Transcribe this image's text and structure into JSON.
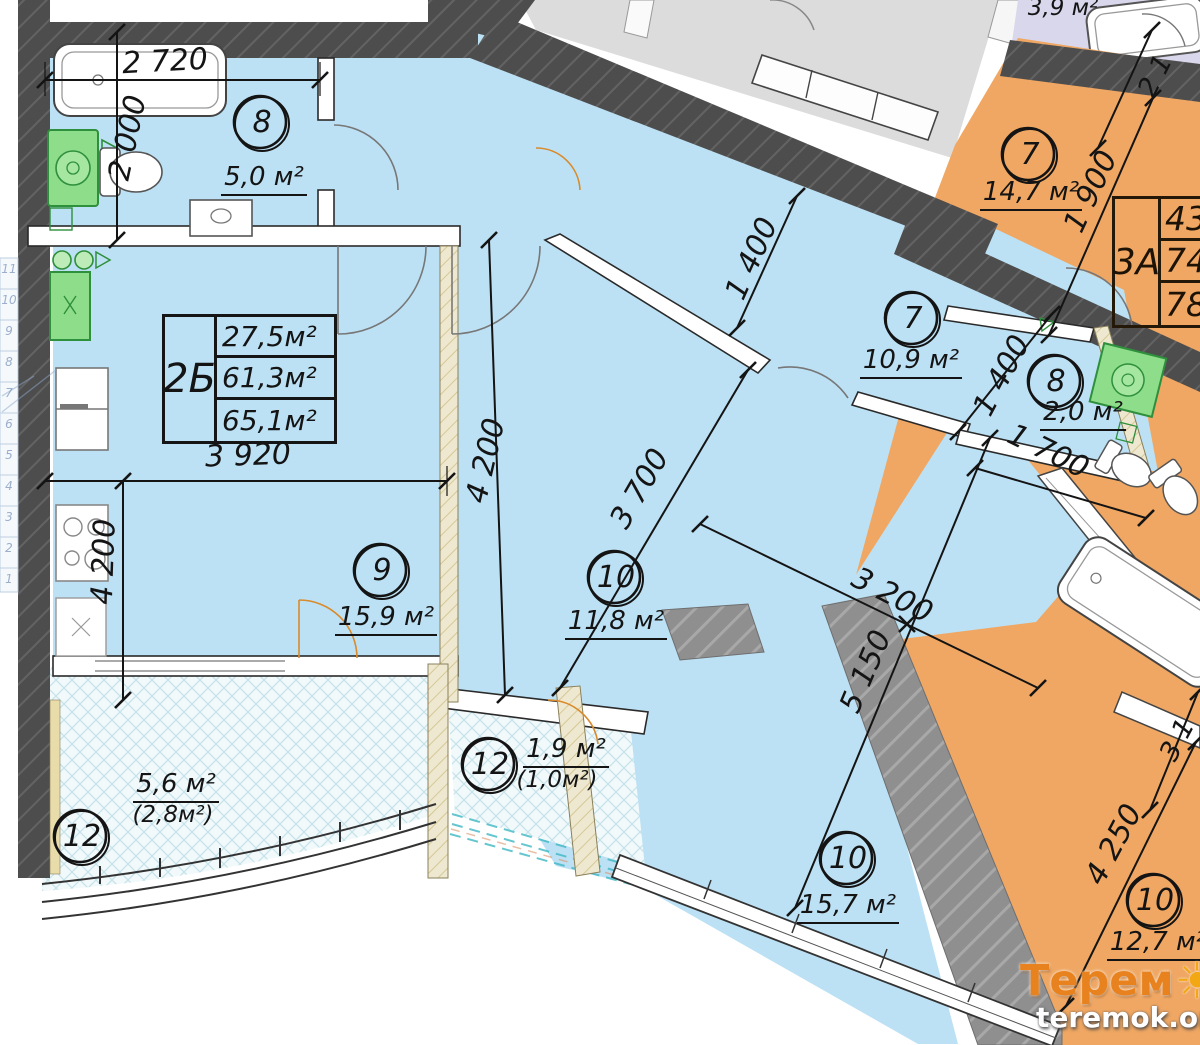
{
  "plan": {
    "table2b": {
      "label": "2Б",
      "rows": [
        "27,5м²",
        "61,3м²",
        "65,1м²"
      ]
    },
    "table3a": {
      "label": "3А",
      "rows": [
        "43",
        "74",
        "78"
      ]
    },
    "rooms": {
      "bath_main": {
        "num": "8",
        "area": "5,0 м²"
      },
      "kitchen_living": {
        "num": "9",
        "area": "15,9 м²"
      },
      "room_mid": {
        "num": "10",
        "area": "11,8 м²"
      },
      "hall": {
        "num": "7",
        "area": "10,9 м²"
      },
      "bath_small": {
        "num": "8",
        "area": "2,0 м²"
      },
      "balcony_large": {
        "num": "12",
        "area": "5,6 м²",
        "area_alt": "(2,8м²)"
      },
      "balcony_small": {
        "num": "12",
        "area": "1,9 м²",
        "area_alt": "(1,0м²)"
      },
      "room_bottom": {
        "num": "10",
        "area": "15,7 м²"
      },
      "neighbor_room7": {
        "num": "7",
        "area": "14,7 м²"
      },
      "neighbor_room10": {
        "num": "10",
        "area": "12,7 м²"
      },
      "neighbor_partial": {
        "area": "3,9 м²"
      }
    },
    "dims": {
      "bath_w": "2 720",
      "bath_h": "2 000",
      "kitchen_w": "3 920",
      "kitchen_h": "4 200",
      "mid_h": "4 200",
      "hall_w": "1 400",
      "mid_diag": "3 700",
      "room_w": "3 200",
      "room_h": "5 150",
      "n7_h": "1 900",
      "nbath_w": "1 400",
      "nbath_h": "1 700",
      "n10_h": "4 250",
      "partial_top": "2 1",
      "partial_right": "3 1"
    },
    "stairs": [
      "11",
      "10",
      "9",
      "8",
      "7",
      "6",
      "5",
      "4",
      "3",
      "2",
      "1"
    ],
    "watermark": {
      "brand_left": "Терем",
      "brand_right": "К",
      "url": "teremok.org.ua"
    },
    "colors": {
      "apartment_blue": "#bde1f4",
      "neighbor_orange": "#efa763",
      "neighbor_lavender": "#d8d7ec",
      "neighbor_gray": "#dcdcdc",
      "wall_dark": "#4d4d4d",
      "fixture_green": "#8edd8a",
      "brand_orange": "#e8821e"
    }
  }
}
